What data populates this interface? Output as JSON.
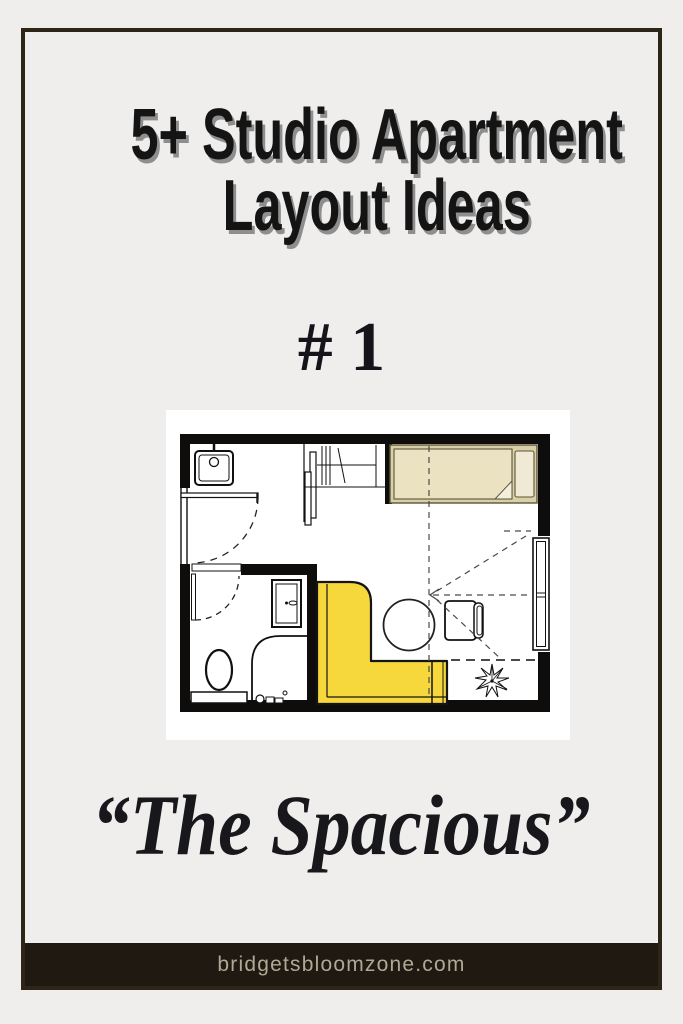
{
  "page": {
    "background": "#efeeec",
    "frame_color": "#2e2519"
  },
  "header": {
    "title_line1": "5+ Studio Apartment",
    "title_line2": "Layout Ideas",
    "item_number": "# 1"
  },
  "caption": {
    "quote": "“The Spacious”"
  },
  "footer": {
    "website": "bridgetsbloomzone.com"
  },
  "floorplan": {
    "type": "studio-apartment-floor-plan",
    "colors": {
      "paper": "#ffffff",
      "walls": "#0e0d0b",
      "sofa_yellow": "#f6d73c",
      "bed_blanket": "#eae2c1",
      "bed_frame": "#d9d0a6",
      "pillow": "#f0ead4"
    },
    "features": [
      "kitchen-sink",
      "kitchen-counter",
      "entry-door-swing",
      "wardrobe-with-hangers",
      "sliding-panels",
      "single-bed",
      "bathroom-door-swing",
      "toilet",
      "shower-stall",
      "vanity-cabinet",
      "l-shaped-sofa",
      "round-table",
      "desk-chair",
      "window",
      "potted-plant",
      "sight-line-guides"
    ]
  }
}
